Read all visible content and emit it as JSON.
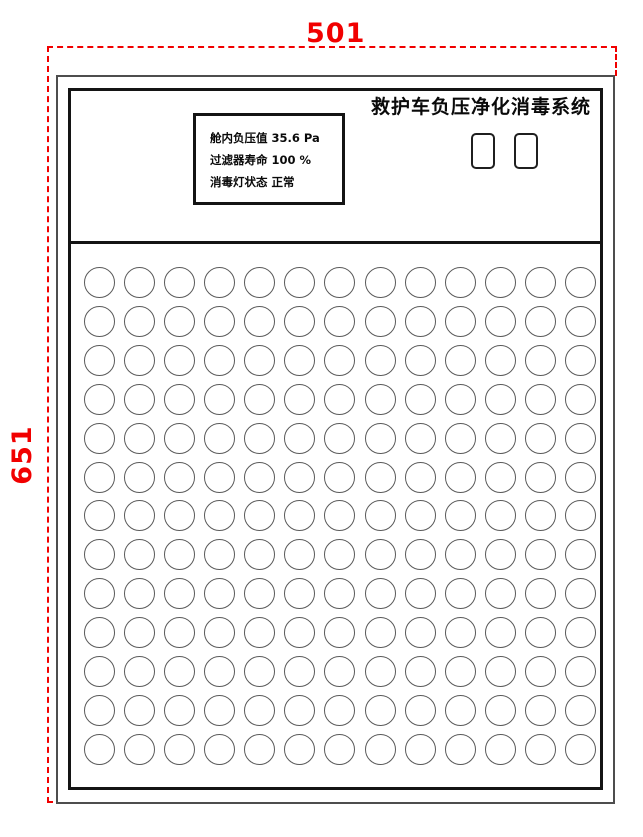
{
  "drawing": {
    "dimensions": {
      "width_label": "501",
      "height_label": "651",
      "color": "#f10000"
    }
  },
  "panel": {
    "title": "救护车负压净化消毒系统",
    "display": {
      "rows": [
        {
          "label": "舱内负压值",
          "value": "35.6 Pa"
        },
        {
          "label": "过滤器寿命",
          "value": "100 %"
        },
        {
          "label": "消毒灯状态",
          "value": "正常"
        }
      ]
    },
    "buttons": [
      {
        "name": "panel-button-1",
        "label": ""
      },
      {
        "name": "panel-button-2",
        "label": ""
      }
    ],
    "vent_grid": {
      "rows": 13,
      "cols": 13,
      "hole_shape": "circle"
    }
  }
}
